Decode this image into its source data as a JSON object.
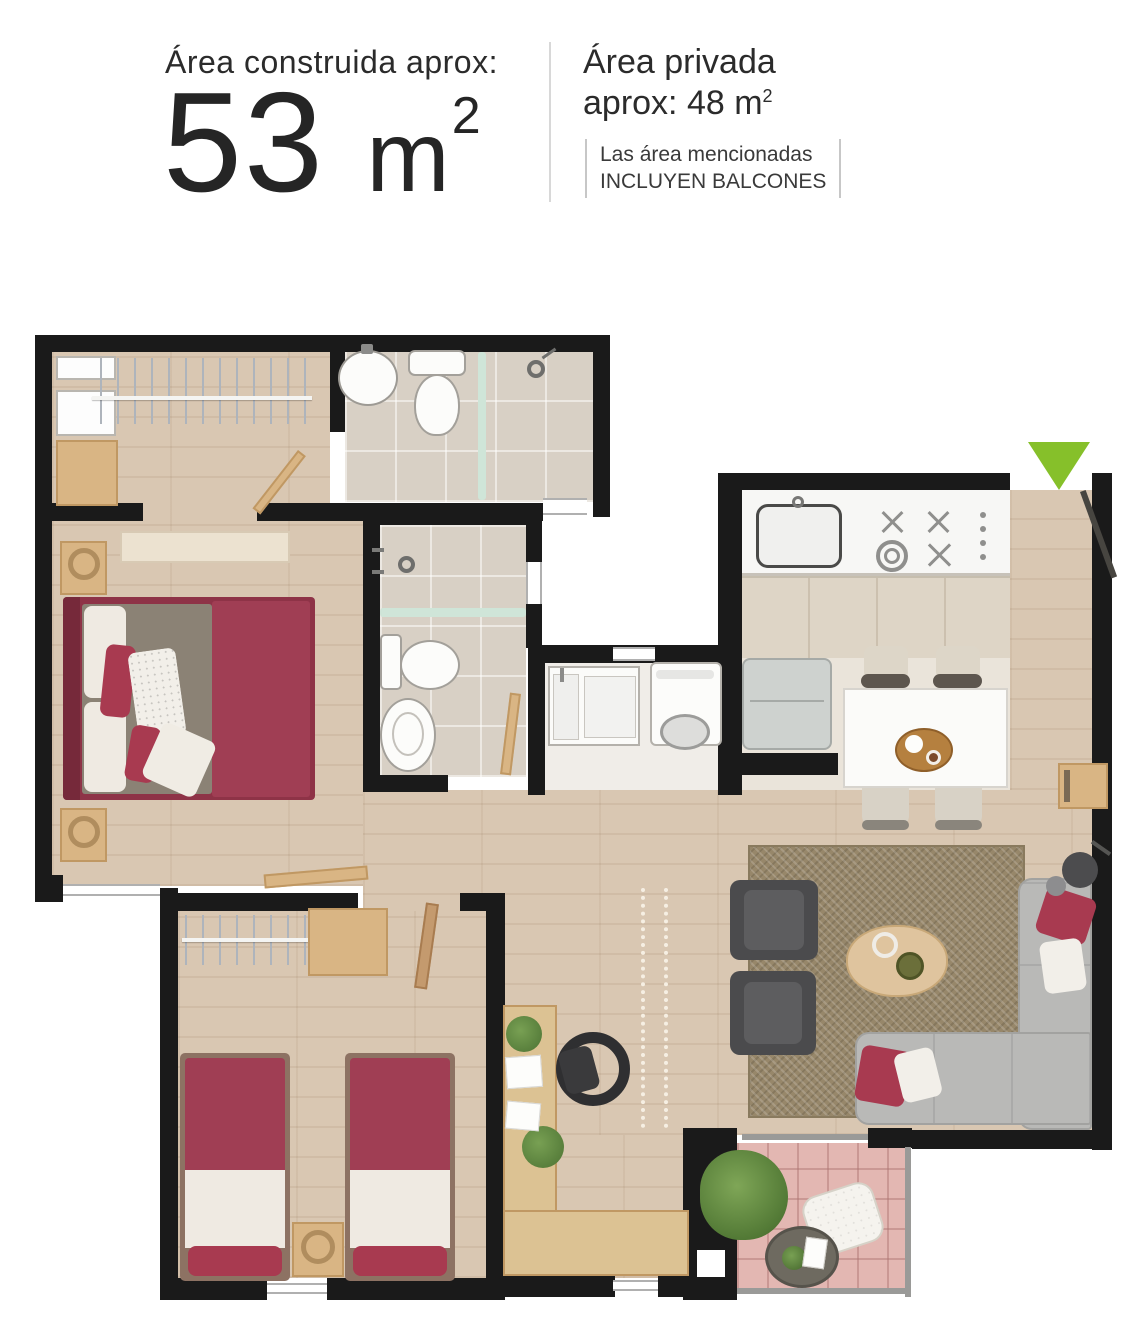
{
  "header": {
    "built_area_label": "Área construida aprox:",
    "built_area_value": "53",
    "built_area_unit": "m",
    "built_area_sup": "2",
    "private_area_line1": "Área privada",
    "private_area_line2": "aprox: 48 m",
    "private_area_sup": "2",
    "note_line1": "Las área mencionadas",
    "note_line2": "INCLUYEN BALCONES"
  },
  "plan": {
    "rooms": [
      "walk-in-closet",
      "bathroom-1",
      "bathroom-2",
      "laundry",
      "kitchen",
      "dining",
      "entry",
      "master-bedroom",
      "bedroom-2",
      "desk-area",
      "living-room",
      "balcony"
    ],
    "entrance_marker": "green-arrow-down",
    "palette": {
      "wall": "#1a1a1a",
      "wood_floor": "#d9c7b2",
      "tile_floor": "#d8d0c5",
      "balcony_tile": "#e3b7b2",
      "rug": "#97876a",
      "sofa_gray": "#b9b9b7",
      "armchair_dark": "#4b4b4d",
      "bed_red": "#a03e54",
      "pillow_white": "#f0ebe3",
      "wood_furniture": "#d9b584",
      "counter_white": "#f7f7f5",
      "cabinet_beige": "#ded5c6",
      "fridge_gray": "#ced2cf",
      "glass_divider": "#cfe5d8",
      "entrance_arrow_green": "#86c02a",
      "railing_gray": "#9a9a98"
    }
  }
}
